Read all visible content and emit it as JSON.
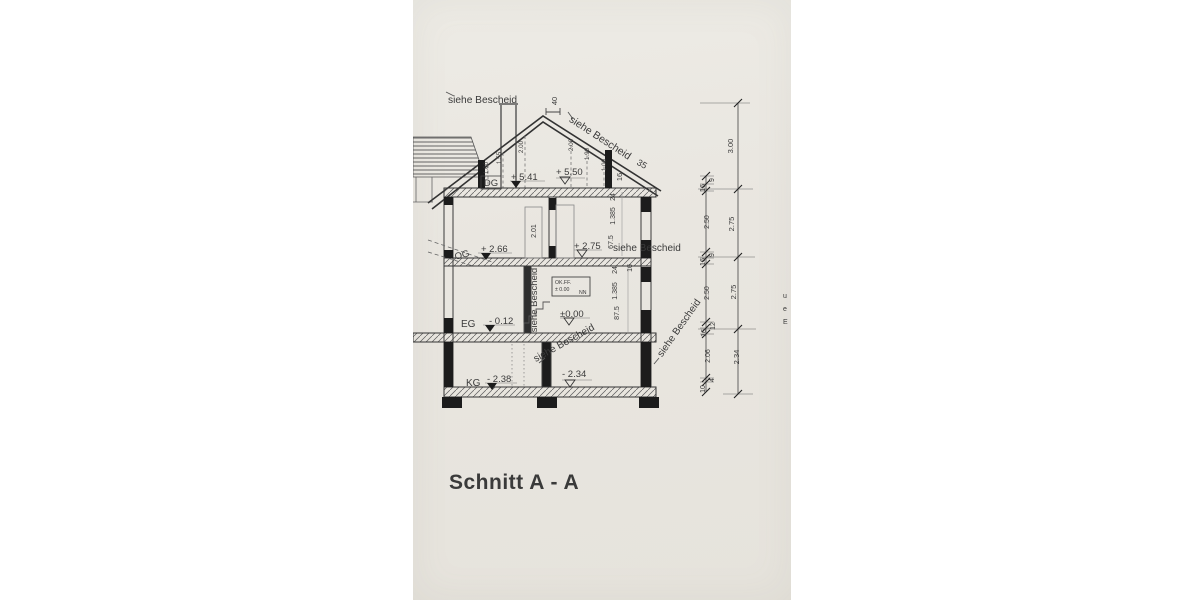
{
  "photo": {
    "paper": "#e9e6e0",
    "ink": "#3a3a3a"
  },
  "title": "Schnitt  A - A",
  "labels": {
    "siehe": "siehe Bescheid",
    "edge_letters": [
      "u",
      "e",
      "E"
    ]
  },
  "floors": {
    "dg": {
      "name": "DG",
      "left": "+ 5.41",
      "right": "+ 5.50"
    },
    "og": {
      "name": "OG",
      "left": "+ 2.66",
      "right": "+ 2.75"
    },
    "eg": {
      "name": "EG",
      "left": "- 0.12",
      "right": "±0.00"
    },
    "kg": {
      "name": "KG",
      "left": "- 2.38",
      "right": "- 2.34"
    }
  },
  "roof": {
    "ridge_dim": "40",
    "eave_dim": "35",
    "wall_top_dim": "16",
    "rafter_dims": [
      "1.00",
      "1.55",
      "2.00",
      "2.00",
      "1.90",
      "1.00"
    ]
  },
  "datum_box": {
    "line1": "OK.FF.",
    "line2": "± 0.00",
    "line3": "NN"
  },
  "interior": {
    "door_height": "2.01",
    "wall_dims_upper": [
      "24",
      "1.385",
      "67.5"
    ],
    "wall_dims_lower": [
      "16",
      "24",
      "1.385",
      "87.5"
    ]
  },
  "chains": {
    "inner": [
      "9",
      "16",
      "2.50",
      "9",
      "16",
      "2.50",
      "12",
      "16",
      "2.06",
      "4",
      "10"
    ],
    "outer": [
      "3.00",
      "2.75",
      "2.75",
      "2.34"
    ]
  }
}
